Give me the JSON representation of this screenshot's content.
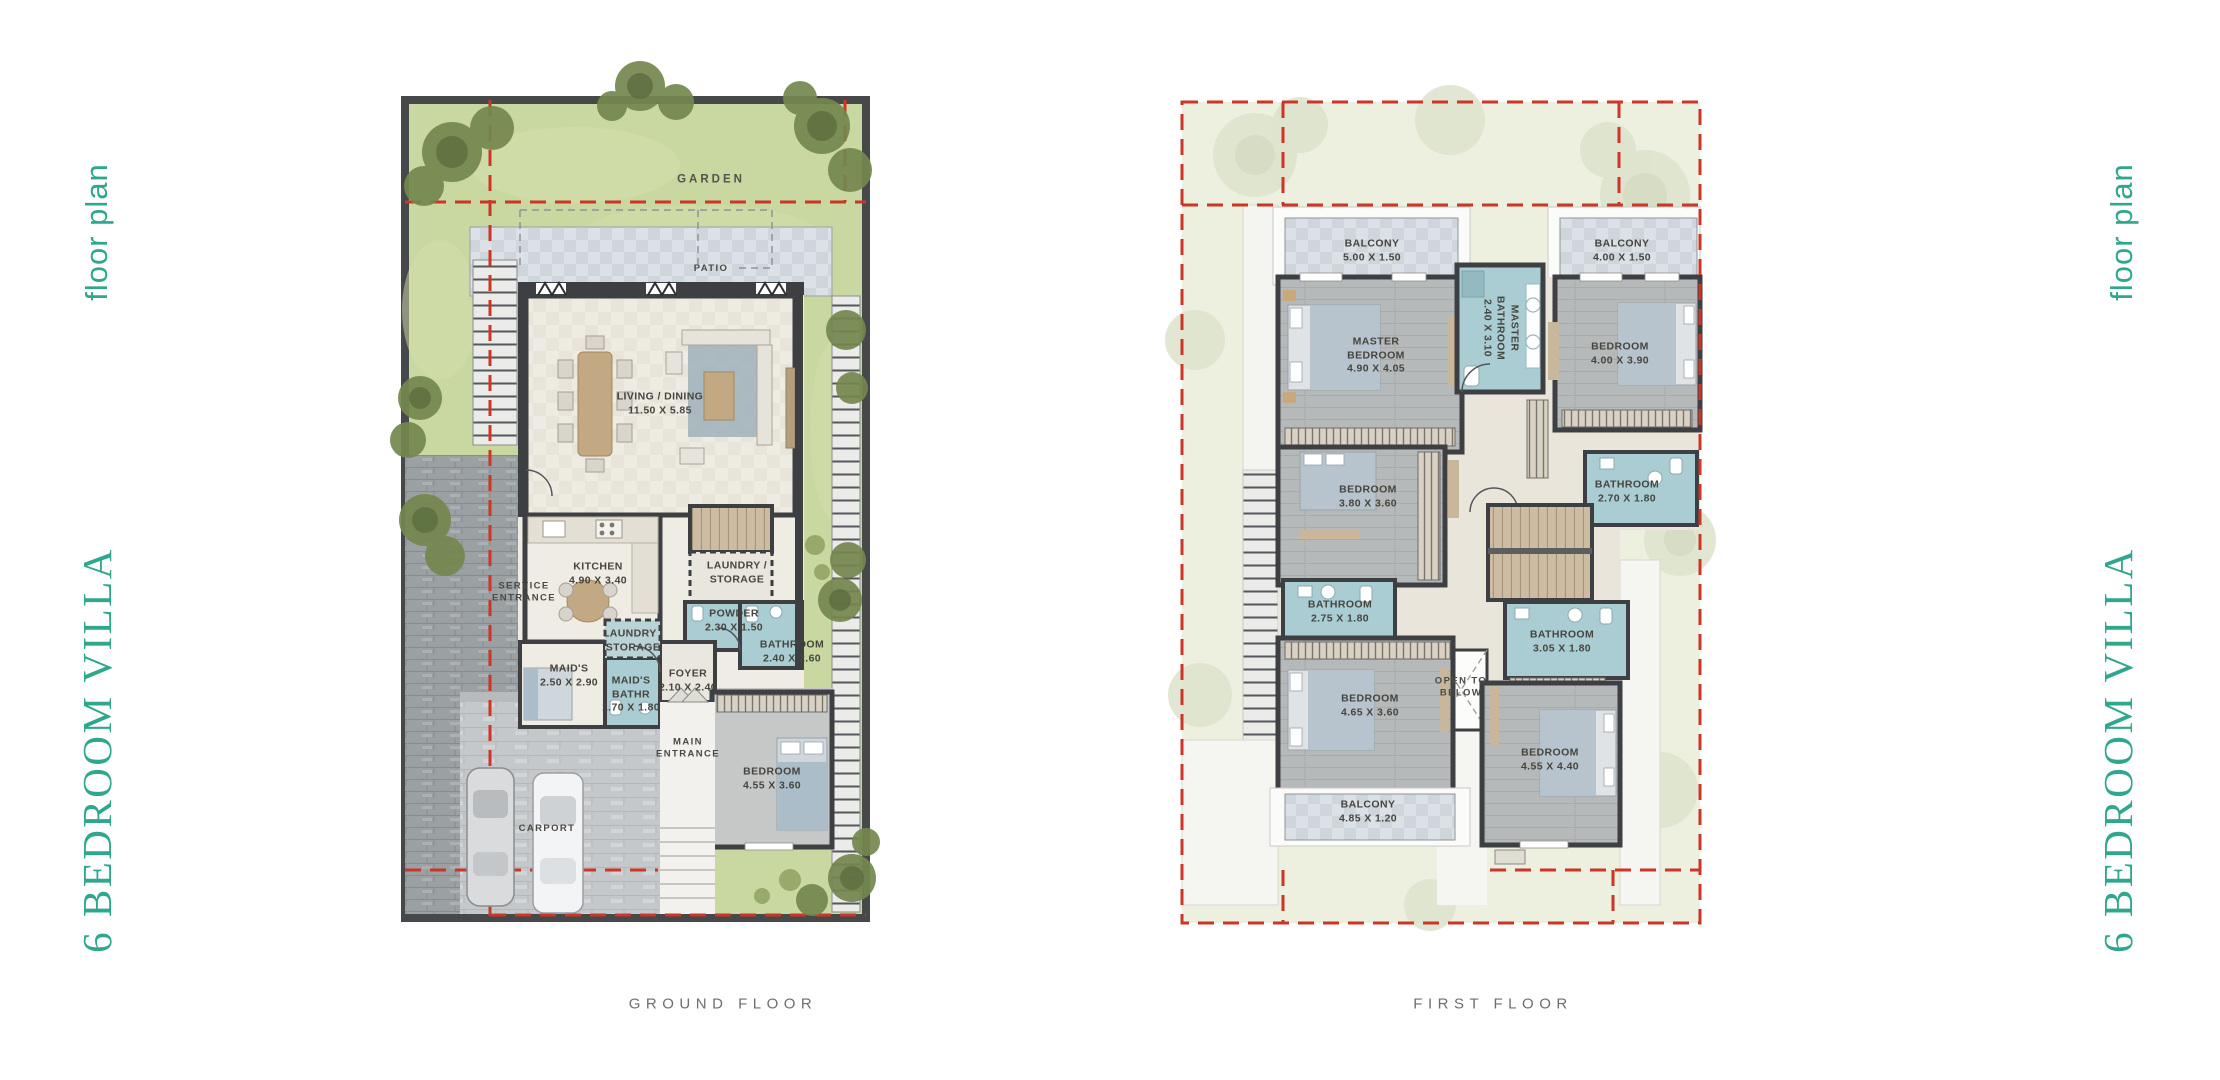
{
  "side_labels": {
    "left_small": "floor plan",
    "left_big": "6 BEDROOM VILLA",
    "right_small": "floor plan",
    "right_big": "6 BEDROOM VILLA"
  },
  "footer": {
    "ground_label": "GROUND FLOOR",
    "first_label": "FIRST FLOOR"
  },
  "colors": {
    "accent_teal": "#2fa78c",
    "plot_red_dash": "#cc3627",
    "garden_green": "#c9d7a0",
    "first_floor_plot": "#edefdf",
    "wet_room_blue": "#a9cdd3",
    "wall_dark": "#3d3f42"
  },
  "plans": {
    "ground": {
      "title": "GROUND FLOOR",
      "labels": [
        {
          "t": "GARDEN",
          "x": 711,
          "y": 180,
          "cls": "zone"
        },
        {
          "t": "PATIO",
          "x": 711,
          "y": 269,
          "cls": "sub"
        },
        {
          "t": "LIVING / DINING\n11.50 X 5.85",
          "x": 660,
          "y": 404
        },
        {
          "t": "KITCHEN\n4.90 X 3.40",
          "x": 598,
          "y": 574
        },
        {
          "t": "LAUNDRY /\nSTORAGE",
          "x": 737,
          "y": 573
        },
        {
          "t": "SERVICE\nENTRANCE",
          "x": 524,
          "y": 593,
          "cls": "sub"
        },
        {
          "t": "LAUNDRY /\nSTORAGE",
          "x": 633,
          "y": 641
        },
        {
          "t": "POWDER\n2.30 X 1.50",
          "x": 734,
          "y": 621
        },
        {
          "t": "BATHROOM\n2.40 X 2.60",
          "x": 792,
          "y": 652
        },
        {
          "t": "MAID'S\n2.50 X 2.90",
          "x": 569,
          "y": 676
        },
        {
          "t": "MAID'S\nBATHR\n1.70 X 1.80",
          "x": 631,
          "y": 695
        },
        {
          "t": "FOYER\n2.10 X 2.40",
          "x": 688,
          "y": 681
        },
        {
          "t": "MAIN\nENTRANCE",
          "x": 688,
          "y": 749,
          "cls": "sub"
        },
        {
          "t": "BEDROOM\n4.55 X 3.60",
          "x": 772,
          "y": 779
        },
        {
          "t": "CARPORT",
          "x": 547,
          "y": 829,
          "cls": "sub"
        }
      ]
    },
    "first": {
      "title": "FIRST FLOOR",
      "labels": [
        {
          "t": "BALCONY\n5.00 X 1.50",
          "x": 1372,
          "y": 251
        },
        {
          "t": "BALCONY\n4.00 X 1.50",
          "x": 1622,
          "y": 251
        },
        {
          "t": "MASTER\nBEDROOM\n4.90 X 4.05",
          "x": 1376,
          "y": 356
        },
        {
          "t": "MASTER\nBATHROOM\n2.40 X 3.10",
          "x": 1500,
          "y": 328,
          "rot": 90
        },
        {
          "t": "BEDROOM\n4.00 X 3.90",
          "x": 1620,
          "y": 354
        },
        {
          "t": "BATHROOM\n2.70 X 1.80",
          "x": 1627,
          "y": 492
        },
        {
          "t": "BEDROOM\n3.80 X 3.60",
          "x": 1368,
          "y": 497
        },
        {
          "t": "BATHROOM\n2.75 X 1.80",
          "x": 1340,
          "y": 612
        },
        {
          "t": "BATHROOM\n3.05 X 1.80",
          "x": 1562,
          "y": 642
        },
        {
          "t": "OPEN TO\nBELOW",
          "x": 1461,
          "y": 688,
          "cls": "sub"
        },
        {
          "t": "BEDROOM\n4.65 X 3.60",
          "x": 1370,
          "y": 706
        },
        {
          "t": "BALCONY\n4.85 X 1.20",
          "x": 1368,
          "y": 812
        },
        {
          "t": "BEDROOM\n4.55 X 4.40",
          "x": 1550,
          "y": 760
        }
      ]
    }
  }
}
